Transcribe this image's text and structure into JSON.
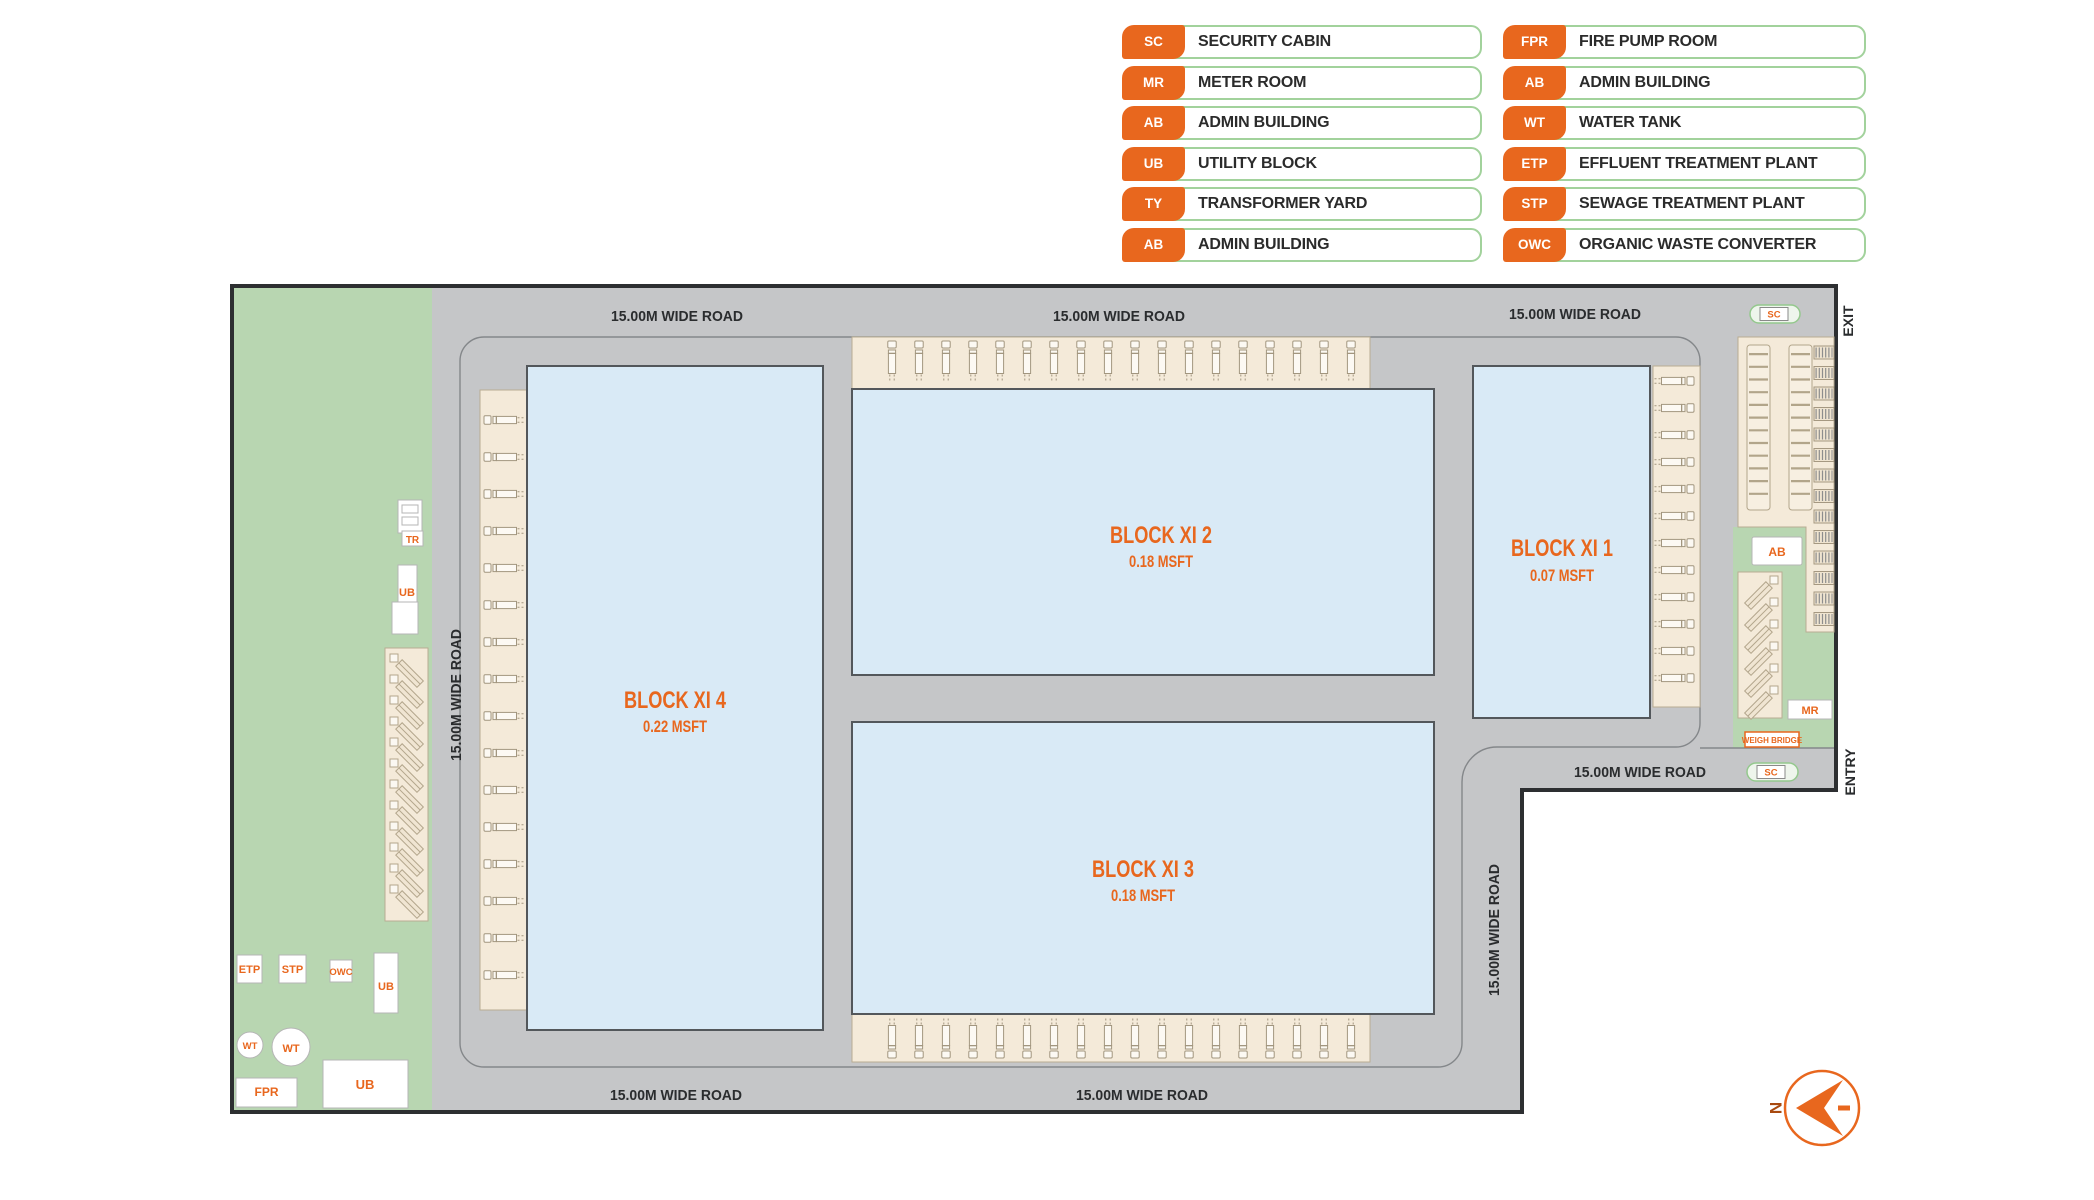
{
  "colors": {
    "accent": "#E8671E",
    "road_gray": "#c5c6c8",
    "green": "#b8d6b1",
    "block_fill": "#d9eaf6",
    "dock_fill": "#f4ead9",
    "legend_border": "#a2d29c",
    "plan_border": "#2d2f31",
    "text_dark": "#2a2c2e"
  },
  "legend": {
    "columns": [
      {
        "items": [
          {
            "code": "SC",
            "label": "SECURITY CABIN"
          },
          {
            "code": "MR",
            "label": "METER ROOM"
          },
          {
            "code": "AB",
            "label": "ADMIN BUILDING"
          },
          {
            "code": "UB",
            "label": "UTILITY BLOCK"
          },
          {
            "code": "TY",
            "label": "TRANSFORMER YARD"
          },
          {
            "code": "AB",
            "label": "ADMIN BUILDING"
          }
        ]
      },
      {
        "items": [
          {
            "code": "FPR",
            "label": "FIRE PUMP ROOM"
          },
          {
            "code": "AB",
            "label": "ADMIN BUILDING"
          },
          {
            "code": "WT",
            "label": "WATER TANK"
          },
          {
            "code": "ETP",
            "label": "EFFLUENT TREATMENT PLANT"
          },
          {
            "code": "STP",
            "label": "SEWAGE TREATMENT PLANT"
          },
          {
            "code": "OWC",
            "label": "ORGANIC WASTE CONVERTER"
          }
        ]
      }
    ]
  },
  "plan": {
    "road_label": "15.00M WIDE ROAD",
    "exit_label": "EXIT",
    "entry_label": "ENTRY",
    "north_label": "N",
    "blocks": [
      {
        "name": "BLOCK XI 4",
        "area": "0.22 MSFT"
      },
      {
        "name": "BLOCK XI 2",
        "area": "0.18 MSFT"
      },
      {
        "name": "BLOCK XI 3",
        "area": "0.18 MSFT"
      },
      {
        "name": "BLOCK XI 1",
        "area": "0.07 MSFT"
      }
    ],
    "markers": {
      "sc": "SC",
      "tr": "TR",
      "ub": "UB",
      "ab": "AB",
      "mr": "MR",
      "wt": "WT",
      "etp": "ETP",
      "stp": "STP",
      "owc": "OWC",
      "fpr": "FPR",
      "weigh_bridge": "WEIGH BRIDGE"
    }
  }
}
